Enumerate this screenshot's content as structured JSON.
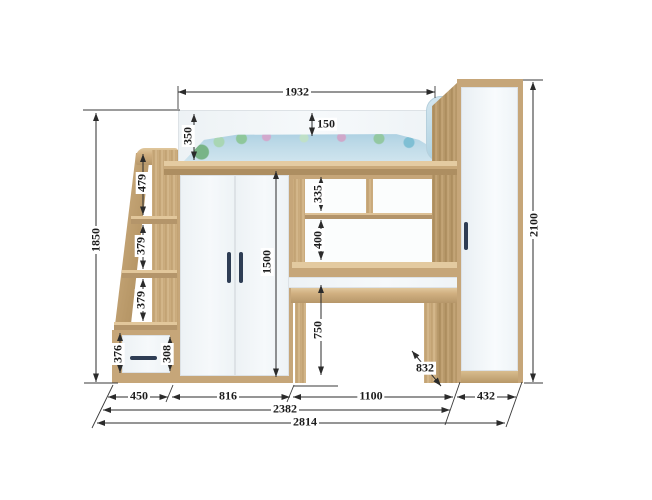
{
  "drawing": {
    "kind": "loft-bed furniture technical drawing",
    "units": "mm"
  },
  "dims": {
    "bed_length": "1932",
    "guard_rail_height": "350",
    "mattress_gap": "150",
    "height_left": "1850",
    "height_right": "2100",
    "stair_rail": "479",
    "stair_step_upper": "379",
    "stair_step_lower": "379",
    "stair_drawer_outer": "376",
    "stair_drawer_front": "308",
    "wardrobe_front_height": "1500",
    "shelf_top": "335",
    "shelf_middle": "400",
    "desk_clearance": "750",
    "desk_depth": "832",
    "width_stairs": "450",
    "width_wardrobe": "816",
    "width_desk": "1100",
    "width_cabinet": "432",
    "width_span": "2382",
    "width_total": "2814"
  },
  "palette": {
    "wood": "#c6a679",
    "wood_dark": "#a8895e",
    "wood_light": "#e0c79e",
    "panel_white": "#f3f7f9",
    "handle_navy": "#2e3d54",
    "bedding_blue": "#aed3e3",
    "floral_green": "#83bf92",
    "floral_pink": "#d2a3cb",
    "dimension_line": "#2b2b2b"
  }
}
